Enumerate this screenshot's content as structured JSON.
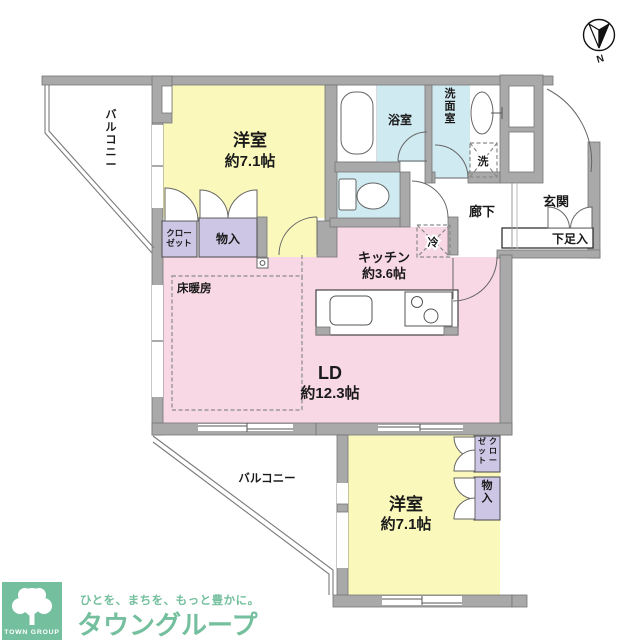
{
  "colors": {
    "wall_gray": "#a9a9a9",
    "bedroom_yellow": "#faf8bb",
    "living_pink": "#f8d8e4",
    "wet_area_blue": "#cfeaf0",
    "storage_lavender": "#cdc6e5",
    "brand_green": "#74bf9d"
  },
  "floorplan": {
    "rooms": {
      "bedroom1": {
        "name": "洋室",
        "size": "約7.1帖"
      },
      "bedroom2": {
        "name": "洋室",
        "size": "約7.1帖"
      },
      "living_dining": {
        "name": "LD",
        "size": "約12.3帖"
      },
      "kitchen": {
        "name": "キッチン",
        "size": "約3.6帖"
      },
      "bathroom": {
        "name": "浴室"
      },
      "washroom": {
        "name": "洗面室"
      },
      "hallway": {
        "name": "廊下"
      },
      "entrance": {
        "name": "玄関"
      },
      "balcony_top": {
        "name": "バルコニー"
      },
      "balcony_bottom": {
        "name": "バルコニー"
      }
    },
    "features": {
      "floor_heating": "床暖房",
      "refrigerator_space": "冷",
      "washer_space": "洗",
      "shoe_cabinet": "下足入",
      "closet1_line1": "クロー",
      "closet1_line2": "ゼット",
      "storage1": "物入",
      "closet2_col1": "クロー",
      "closet2_col2": "ゼット",
      "storage2": "物入"
    },
    "compass": {
      "north": "N"
    }
  },
  "branding": {
    "logo_box": "TOWN GROUP",
    "tagline": "ひとを、まちを、もっと豊かに。",
    "company": "タウングループ"
  }
}
